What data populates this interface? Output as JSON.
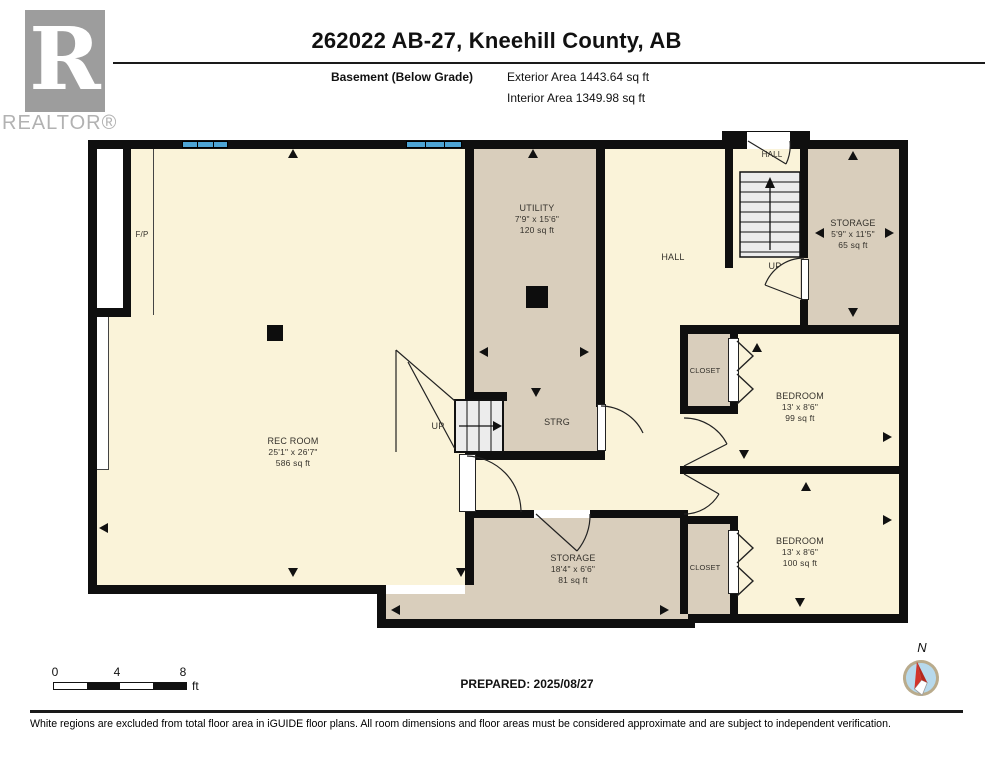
{
  "header": {
    "logo_letter": "R",
    "brand": "REALTOR®",
    "title": "262022 AB-27, Kneehill County, AB",
    "floor_label": "Basement (Below Grade)",
    "exterior_area": "Exterior Area 1443.64 sq ft",
    "interior_area": "Interior Area 1349.98 sq ft"
  },
  "plan": {
    "rooms": {
      "rec_room": {
        "name": "REC ROOM",
        "dims": "25'1\" x 26'7\"",
        "area": "586 sq ft"
      },
      "utility": {
        "name": "UTILITY",
        "dims": "7'9\" x 15'6\"",
        "area": "120 sq ft"
      },
      "strg": {
        "name": "STRG"
      },
      "hall": {
        "name": "HALL"
      },
      "hall_upper": {
        "name": "HALL"
      },
      "storage_upper": {
        "name": "STORAGE",
        "dims": "5'9\" x 11'5\"",
        "area": "65 sq ft"
      },
      "bedroom_1": {
        "name": "BEDROOM",
        "dims": "13' x 8'6\"",
        "area": "99 sq ft"
      },
      "bedroom_2": {
        "name": "BEDROOM",
        "dims": "13' x 8'6\"",
        "area": "100 sq ft"
      },
      "storage_lower": {
        "name": "STORAGE",
        "dims": "18'4\" x 6'6\"",
        "area": "81 sq ft"
      },
      "closet_1": {
        "name": "CLOSET"
      },
      "closet_2": {
        "name": "CLOSET"
      },
      "fireplace": {
        "name": "F/P"
      },
      "stairs_center_label": "UP",
      "stairs_upper_label": "UP"
    }
  },
  "footer": {
    "scale_ticks": [
      "0",
      "4",
      "8"
    ],
    "scale_unit": "ft",
    "prepared": "PREPARED: 2025/08/27",
    "compass_label": "N",
    "disclaimer": "White regions are excluded from total floor area in iGUIDE floor plans. All room dimensions and floor areas must be considered approximate and are subject to independent verification."
  },
  "colors": {
    "room_cream": "#FAF3D9",
    "room_tan": "#D9CEBC",
    "wall_black": "#0F0F0F",
    "window_blue": "#4DA4D4",
    "compass_red": "#D2342A",
    "logo_gray": "#9D9D9D"
  }
}
